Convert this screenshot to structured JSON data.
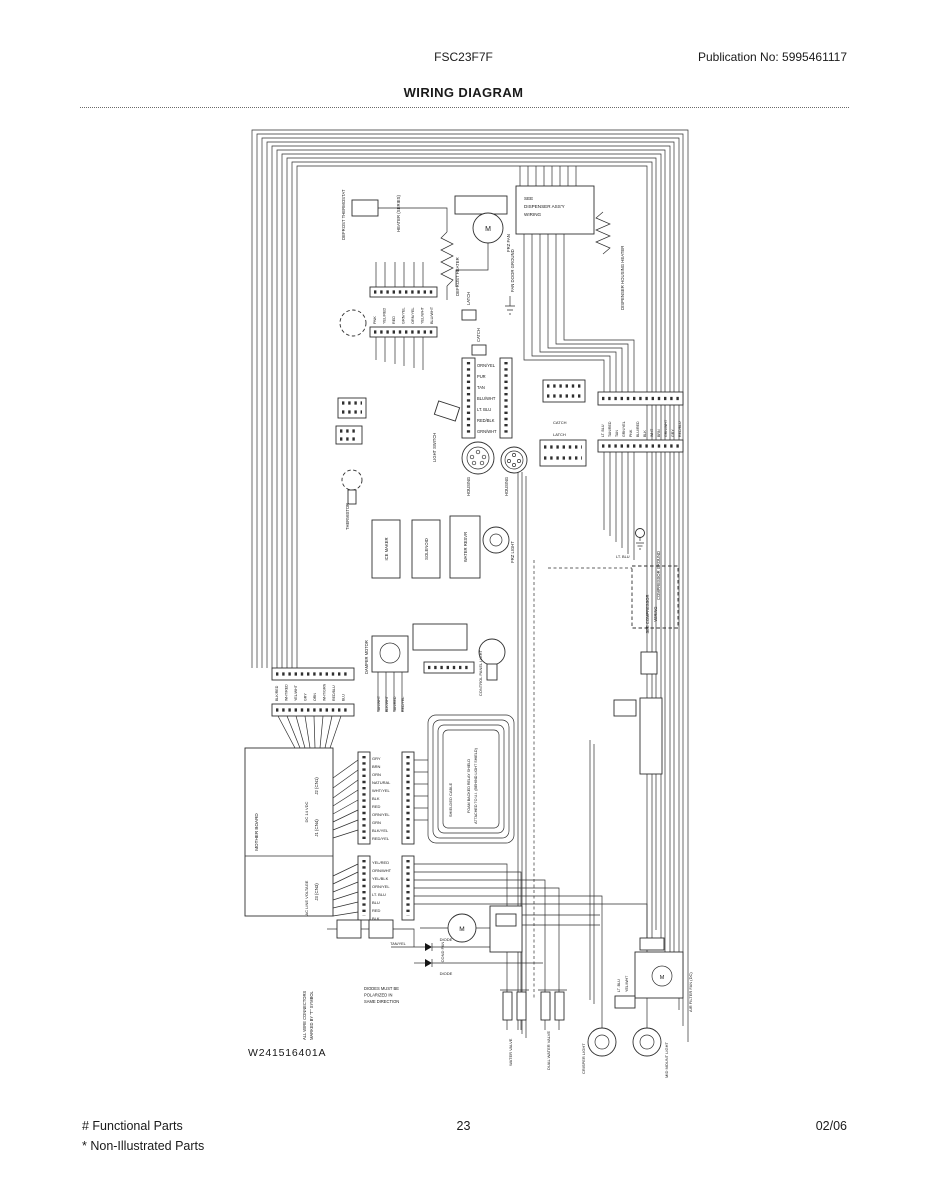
{
  "header": {
    "model": "FSC23F7F",
    "publication": "Publication No:  5995461117",
    "title": "WIRING DIAGRAM"
  },
  "footer": {
    "functional": "# Functional Parts",
    "non_illustrated": "* Non-Illustrated Parts",
    "page": "23",
    "date": "02/06"
  },
  "diagram": {
    "part_number": "W241516401A",
    "labels": {
      "defrost_thermostat": "DEFROST THERMOSTAT",
      "heater_series": "HEATER (SERIES)",
      "defrost_heater": "DEFROST HEATER",
      "frz_fan": "FRZ FAN",
      "motor_m": "M",
      "see_dispenser_1": "SEE",
      "see_dispenser_2": "DISPENSER ASS'Y",
      "see_dispenser_3": "WIRING",
      "dispenser_housing_heater": "DISPENSER HOUSING HEATER",
      "fan_door_ground": "FAN DOOR GROUND",
      "latch": "LATCH",
      "catch": "CATCH",
      "housing": "HOUSING",
      "light_switch": "LIGHT SWITCH",
      "ice_maker": "ICE MAKER",
      "solenoid": "SOLENOID",
      "water_resvr": "WATER RESVR",
      "frz_light": "FRZ LIGHT",
      "thermistor": "THERMISTOR",
      "damper_motor": "DAMPER MOTOR",
      "control_panel_light": "CONTROL PANEL LIGHT",
      "mother_board": "MOTHER BOARD",
      "j2": "J2 (CN1)",
      "j1": "J1 (CN4)",
      "dc_voltage": "DC 14 VDC",
      "j3": "J3 (CN3)",
      "ac_line": "AC LINE VOLTAGE",
      "shielded_cable": "SHIELDED CABLE",
      "foam_note_1": "FOAM BACKED RELAY SHIELD",
      "foam_note_2": "ATTACHED TO U.I. (BEHIND LIGHT SHIELD)",
      "compressor_ground": "COMPRESSOR GROUND",
      "see_compressor_1": "SEE COMPRESSOR",
      "see_compressor_2": "WIRING",
      "lt_blu": "LT. BLU",
      "cond_fan": "COND FAN",
      "diode": "DIODE",
      "tan_yel": "TAN/YEL",
      "diode_note_1": "DIODES MUST BE",
      "diode_note_2": "POLARIZED IN",
      "diode_note_3": "SAME DIRECTION",
      "water_valve": "WATER VALVE",
      "dual_water_valve": "DUAL WATER VALVE",
      "air_filter_fan": "AIR FILTER FAN (DC)",
      "yel_wht": "YEL/WHT",
      "crisper_light": "CRISPER LIGHT",
      "mid_mount_light": "MID MOUNT LIGHT",
      "connector_note_1": "ALL WIRE CONNECTORS",
      "connector_note_2": "MARKED BY \"T\" SYMBOL"
    },
    "wires": {
      "top_strip": [
        "PNK",
        "YEL/RED",
        "RED",
        "GRN/YEL",
        "ORN/YEL",
        "YEL/WHT",
        "BLU/WHT"
      ],
      "mid_connector": [
        "ORN/YEL",
        "PUR",
        "TAN",
        "BLU/WHT",
        "LT. BLU",
        "RED/BLK",
        "GRN/WHT"
      ],
      "right_strip": [
        "LT. BLU",
        "TAN/RED",
        "TAN",
        "GRN/YEL",
        "PNK",
        "BLU/RED",
        "BLK",
        "WHT",
        "BRN",
        "GRN/WHT",
        "GRY",
        "RED/BLU"
      ],
      "left_strip": [
        "BLK/RED",
        "WHT/RED",
        "YEL/WHT",
        "GRY",
        "ORN",
        "WHT/GRN",
        "RED/BLU",
        "BLU"
      ],
      "j1": [
        "GRY",
        "BRN",
        "ORN",
        "NATURAL",
        "WHT/YEL",
        "BLK",
        "RED",
        "ORN/YEL",
        "GRN",
        "BLK/YEL",
        "RED/YEL"
      ],
      "j3": [
        "YEL/RED",
        "ORN/WHT",
        "YEL/BLK",
        "ORN/YEL",
        "LT. BLU",
        "BLU",
        "RED",
        "BLK"
      ],
      "damper": [
        "TAN/WHT",
        "BLK/WHT",
        "TAN/RED",
        "RED/YEL"
      ]
    }
  }
}
